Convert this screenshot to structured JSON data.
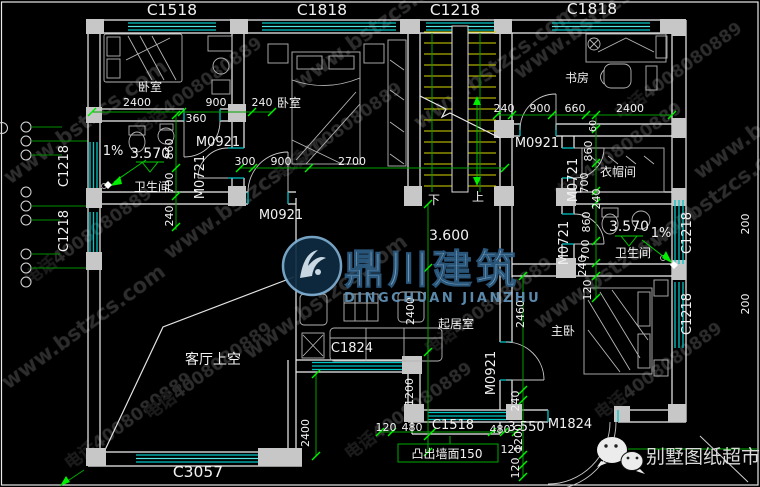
{
  "watermark": {
    "url": "www.bstzcs.com",
    "phone": "电话4008080889",
    "logo_cn": "鼎川建筑",
    "logo_en": "DINGCHUAN JIANZHU",
    "brand": "别墅图纸超市"
  },
  "windows": {
    "c1518": "C1518",
    "c1818": "C1818",
    "c1218": "C1218",
    "c1824": "C1824",
    "c3057": "C3057"
  },
  "doors": {
    "m0921": "M0921",
    "m0721": "M0721",
    "m1824": "M1824"
  },
  "rooms": {
    "bedroom": "卧室",
    "study": "书房",
    "bathroom": "卫生间",
    "cloakroom": "衣帽间",
    "living": "起居室",
    "master": "主卧",
    "void": "客厅上空"
  },
  "levels": {
    "l3570": "3.570",
    "l3600": "3.600",
    "l3550": "3.550",
    "slope": "1%"
  },
  "stair": {
    "down": "下",
    "up": "上"
  },
  "notes": {
    "protrusion": "凸出墙面150"
  },
  "dims": {
    "d60": "60",
    "d120": "120",
    "d200": "200",
    "d240": "240",
    "d300": "300",
    "d360": "360",
    "d480": "480",
    "d660": "660",
    "d700": "700",
    "d860": "860",
    "d900": "900",
    "d1200": "1200",
    "d2400": "2400",
    "d2460": "2460",
    "d2700": "2700"
  }
}
